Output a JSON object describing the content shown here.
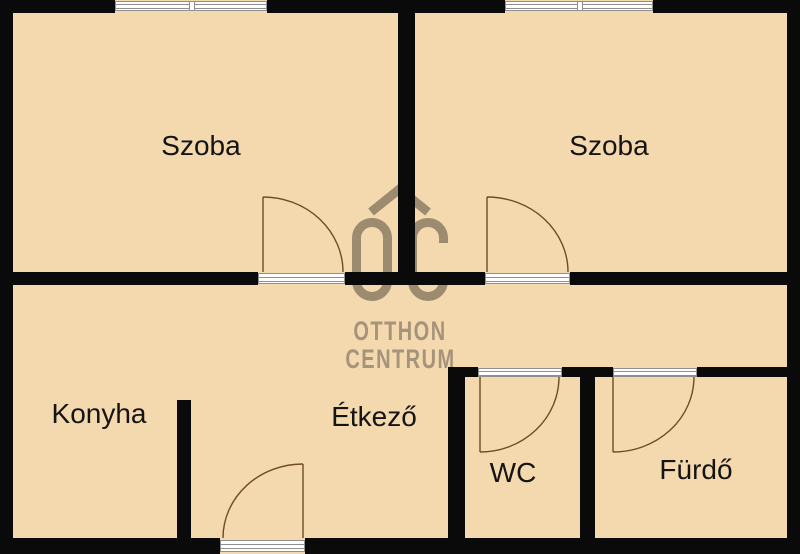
{
  "floorplan": {
    "rooms": [
      {
        "id": "szoba-left",
        "label": "Szoba"
      },
      {
        "id": "szoba-right",
        "label": "Szoba"
      },
      {
        "id": "konyha",
        "label": "Konyha"
      },
      {
        "id": "etkezo",
        "label": "Étkező"
      },
      {
        "id": "wc",
        "label": "WC"
      },
      {
        "id": "furdo",
        "label": "Fürdő"
      }
    ],
    "watermark": {
      "line1": "OTTHON",
      "line2": "CENTRUM",
      "monogram": "OC"
    },
    "symbols": {
      "windows": 2,
      "door_swings": 5
    },
    "colors": {
      "floor": "#f4d8ae",
      "wall": "#0a0a0a",
      "watermark": "#a6937b",
      "monogram": "#9d8b70",
      "door-arc": "#6f4b26",
      "frame-line": "#8f8f8f",
      "frame-fill": "#ffffff",
      "label": "#141414"
    }
  }
}
